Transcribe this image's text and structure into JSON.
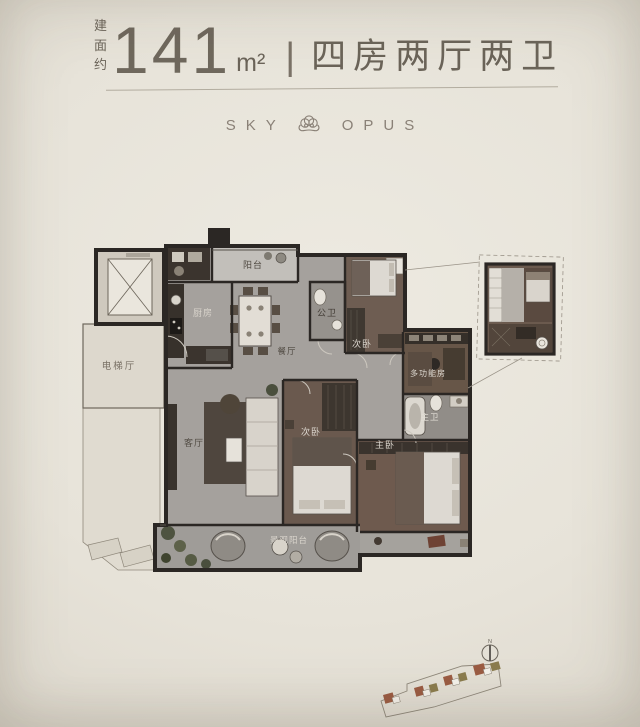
{
  "header": {
    "area_prefix": "建面约",
    "area_value": "141",
    "area_unit": "m²",
    "separator": "|",
    "layout_text": "四房两厅两卫"
  },
  "brand": {
    "word_left": "SKY",
    "word_right": "OPUS",
    "logo": "cloud-ornament-icon"
  },
  "floor_plan": {
    "rooms": {
      "balcony": {
        "label": "阳台"
      },
      "kitchen": {
        "label": "厨房"
      },
      "dining": {
        "label": "餐厅"
      },
      "public_bath": {
        "label": "公卫"
      },
      "bedroom_top": {
        "label": "次卧"
      },
      "multi_function": {
        "label": "多功能房"
      },
      "master_bath": {
        "label": "主卫"
      },
      "elevator_hall": {
        "label": "电梯厅"
      },
      "living": {
        "label": "客厅"
      },
      "bedroom_mid": {
        "label": "次卧"
      },
      "master_bedroom": {
        "label": "主卧"
      },
      "view_balcony": {
        "label": "景观阳台"
      }
    }
  },
  "site_plan": {
    "north_label": "N"
  },
  "colors": {
    "photo_bg": "#e8e4da",
    "heading_text": "#6b6459",
    "brand_text": "#8a8177",
    "wall": "#2b2724",
    "floor_marble": "#a5a19d",
    "floor_wood": "#6b5a4e",
    "floor_balcony": "#c2bfba",
    "common_area": "#ddd8cd",
    "site_building_red": "#9b5c43",
    "site_building_olive": "#8b7c4e"
  }
}
